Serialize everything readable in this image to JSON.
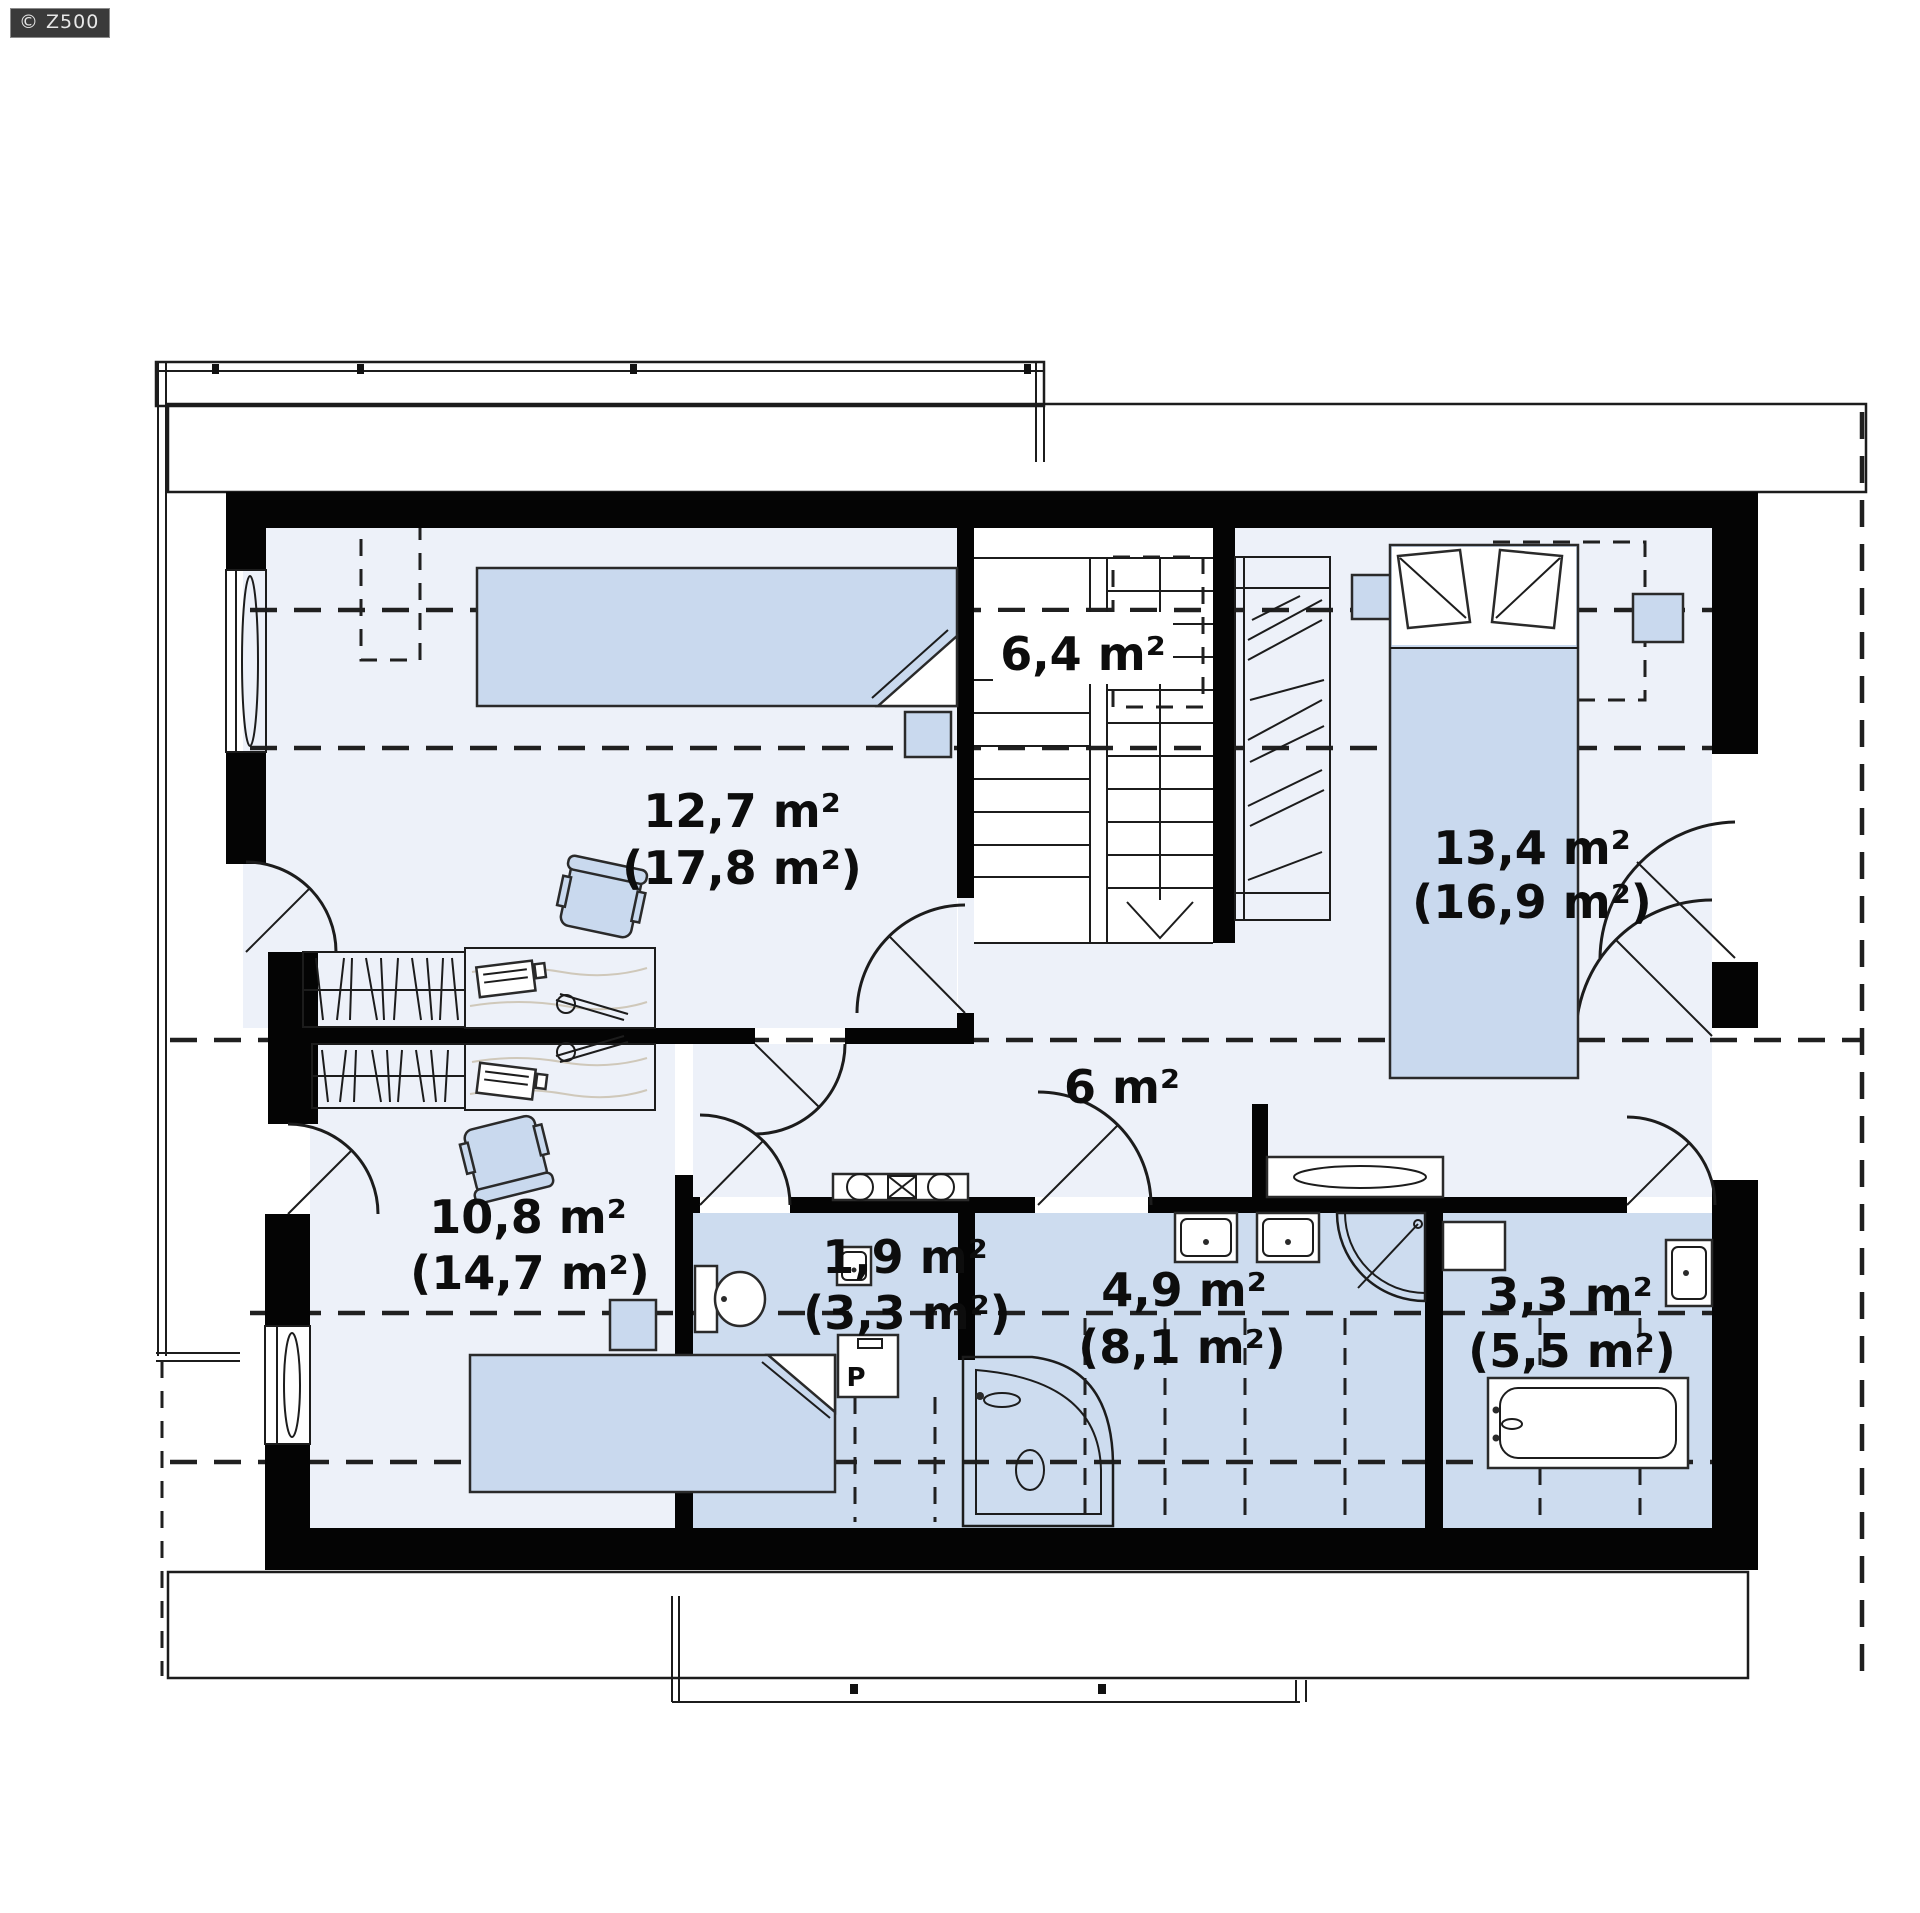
{
  "watermark": {
    "text": "© Z500"
  },
  "floor": {
    "type": "attic-floor-plan",
    "rooms": [
      {
        "id": "bedroom-top-left",
        "area": "12,7 m²",
        "area_full": "(17,8 m²)"
      },
      {
        "id": "staircase",
        "area": "6,4 m²",
        "area_full": ""
      },
      {
        "id": "bedroom-right",
        "area": "13,4 m²",
        "area_full": "(16,9 m²)"
      },
      {
        "id": "hallway",
        "area": "6 m²",
        "area_full": ""
      },
      {
        "id": "bedroom-bottom-left",
        "area": "10,8 m²",
        "area_full": "(14,7 m²)"
      },
      {
        "id": "wc",
        "area": "1,9 m²",
        "area_full": "(3,3 m²)"
      },
      {
        "id": "bathroom-main",
        "area": "4,9 m²",
        "area_full": "(8,1 m²)"
      },
      {
        "id": "bathroom-small",
        "area": "3,3 m²",
        "area_full": "(5,5 m²)"
      }
    ],
    "appliances": {
      "washing_machine_label": "P"
    },
    "colors": {
      "wall": "#040404",
      "room_floor": "#edf1f9",
      "bathroom_floor": "#cddcef",
      "furniture": "#c9d9ee",
      "watermark_bg": "#3a3a3a"
    }
  }
}
